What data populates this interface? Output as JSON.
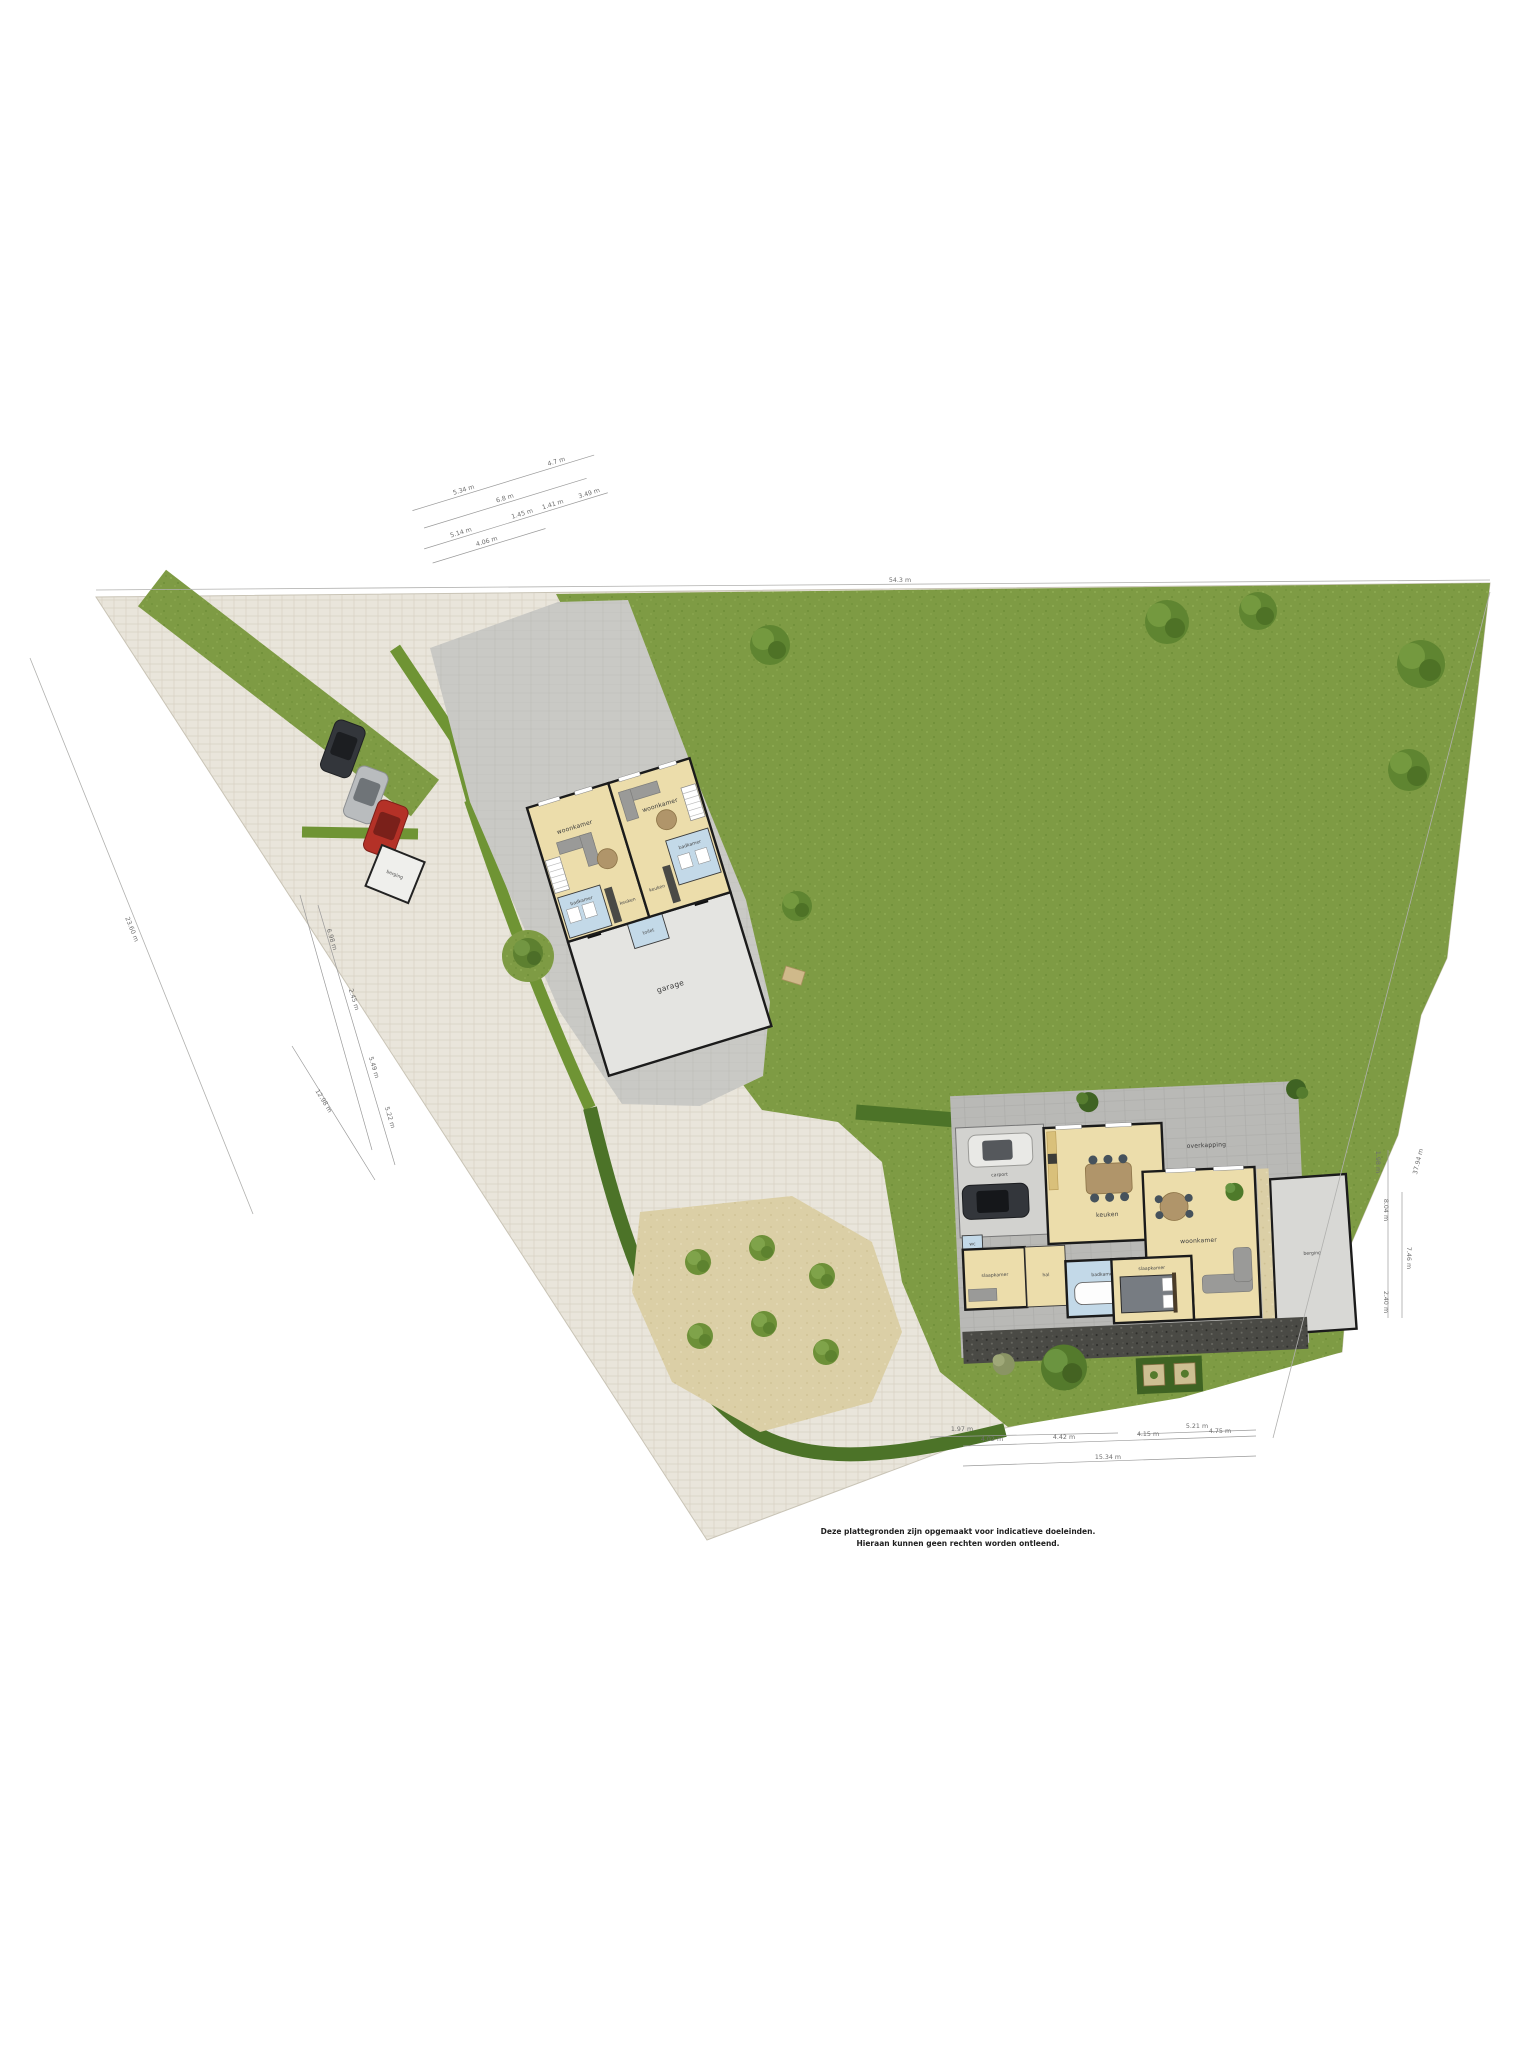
{
  "disclaimer": {
    "line1": "Deze plattegronden zijn opgemaakt voor indicatieve doeleinden.",
    "line2": "Hieraan kunnen geen rechten worden ontleend."
  },
  "left_house": {
    "unit_a": {
      "living": "woonkamer",
      "kitchen": "keuken",
      "bath": "badkamer"
    },
    "unit_b": {
      "living": "woonkamer",
      "kitchen": "keuken",
      "bath": "badkamer"
    },
    "garage": "garage",
    "toilet": "toilet"
  },
  "shed": {
    "label": "berging"
  },
  "right_house": {
    "carport": "carport",
    "kitchen": "keuken",
    "living": "woonkamer",
    "canopy": "overkapping",
    "storage": "berging",
    "bedroom_left": "slaapkamer",
    "bedroom_right": "slaapkamer",
    "bathroom": "badkamer",
    "hall": "hal",
    "wc": "wc"
  },
  "dimensions": {
    "top_group": [
      "5.34 m",
      "4.7 m",
      "6.8 m",
      "5.14 m",
      "1.45 m",
      "1.41 m",
      "3.49 m",
      "4.06 m"
    ],
    "boundary_top": "54.3 m",
    "boundary_left": "23.60 m",
    "left_group": [
      "6.98 m",
      "2.45 m",
      "5.49 m",
      "5.22 m",
      "12.98 m"
    ],
    "right_group": [
      "8.04 m",
      "7.46 m",
      "2.40 m",
      "1.98 m"
    ],
    "boundary_right": "37.94 m",
    "bottom_group": [
      "1.97 m",
      "5.21 m",
      "4.02 m",
      "4.42 m",
      "4.15 m",
      "4.75 m",
      "15.34 m"
    ]
  },
  "colors": {
    "grass": "#7e9b44",
    "paving": "#e9e5db",
    "courtyard": "#c9c9c5",
    "terrace": "#b9b9b6",
    "sand": "#dbcfa6",
    "gravel": "#4a4a45",
    "hedge": "#6f9434",
    "hedge_dark": "#4c7328",
    "room": "#ecddab",
    "wet": "#c3d9e8",
    "garage": "#e4e4e1",
    "wall": "#1b1b1b",
    "car_dark": "#33363b",
    "car_silver": "#b9bcbe",
    "car_red": "#b43127",
    "car_white": "#e9e9e6"
  }
}
